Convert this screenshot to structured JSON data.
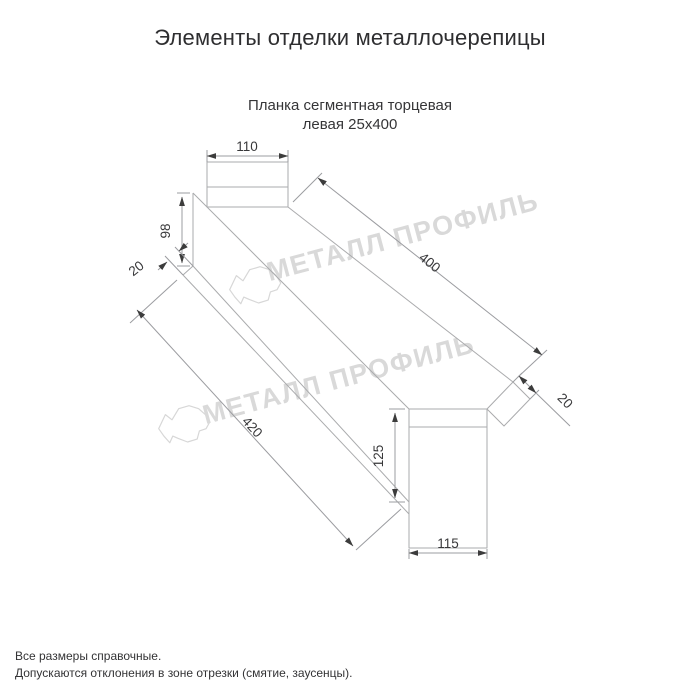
{
  "page": {
    "title": "Элементы отделки металлочерепицы",
    "subtitle_line1": "Планка сегментная торцевая",
    "subtitle_line2": "левая 25х400",
    "footer_line1": "Все размеры справочные.",
    "footer_line2": "Допускаются отклонения в зоне отрезки (смятие, заусенцы)."
  },
  "watermark": {
    "brand_text": "МЕТАЛЛ ПРОФИЛЬ",
    "text_color": "#d9d9d9"
  },
  "drawing": {
    "dimensions": {
      "top_flange_width": "110",
      "near_end_height": "98",
      "near_hem": "20",
      "top_length": "400",
      "far_hem": "20",
      "bottom_length": "420",
      "far_end_height": "125",
      "far_tab_width": "115"
    },
    "colors": {
      "part_line": "#aaabad",
      "dimension_line": "#9b9ca0",
      "dimension_text": "#38383a",
      "arrow": "#3c3c3c"
    }
  }
}
